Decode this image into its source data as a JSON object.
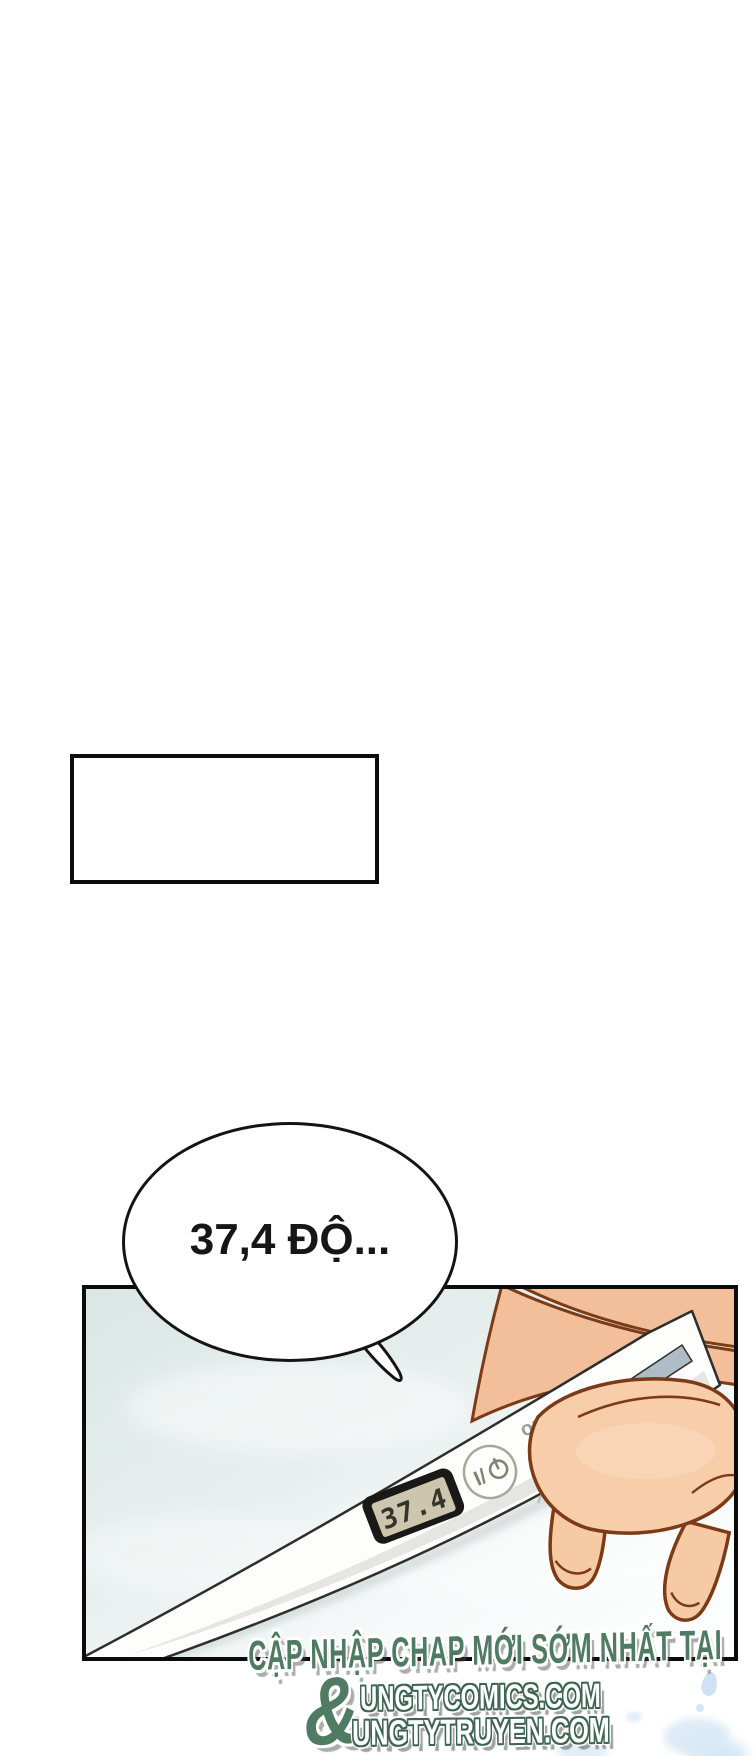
{
  "speech_bubble": {
    "text": "37,4 ĐỘ..."
  },
  "thermometer": {
    "lcd_value": "37.4",
    "power_button_label": "I/",
    "brand_text": "omR"
  },
  "watermark": {
    "line1": "CẬP NHẬP CHAP MỚI SỚM NHẤT TẠI",
    "ampersand": "&",
    "site1": "UNGTYCOMICS.COM",
    "site2": "UNGTYTRUYEN.COM"
  },
  "colors": {
    "watermark_green": "#4e7b62",
    "site_outline_green": "#3e6552",
    "panel_background": "#dbe7e5",
    "skin": "#f2bf9a",
    "skin_light": "#f7cdaa",
    "outline_brown": "#7c3a15",
    "lcd_face": "#cdc5ad",
    "lcd_digits": "#34342b",
    "decor_blue": "#cfe1f2"
  }
}
